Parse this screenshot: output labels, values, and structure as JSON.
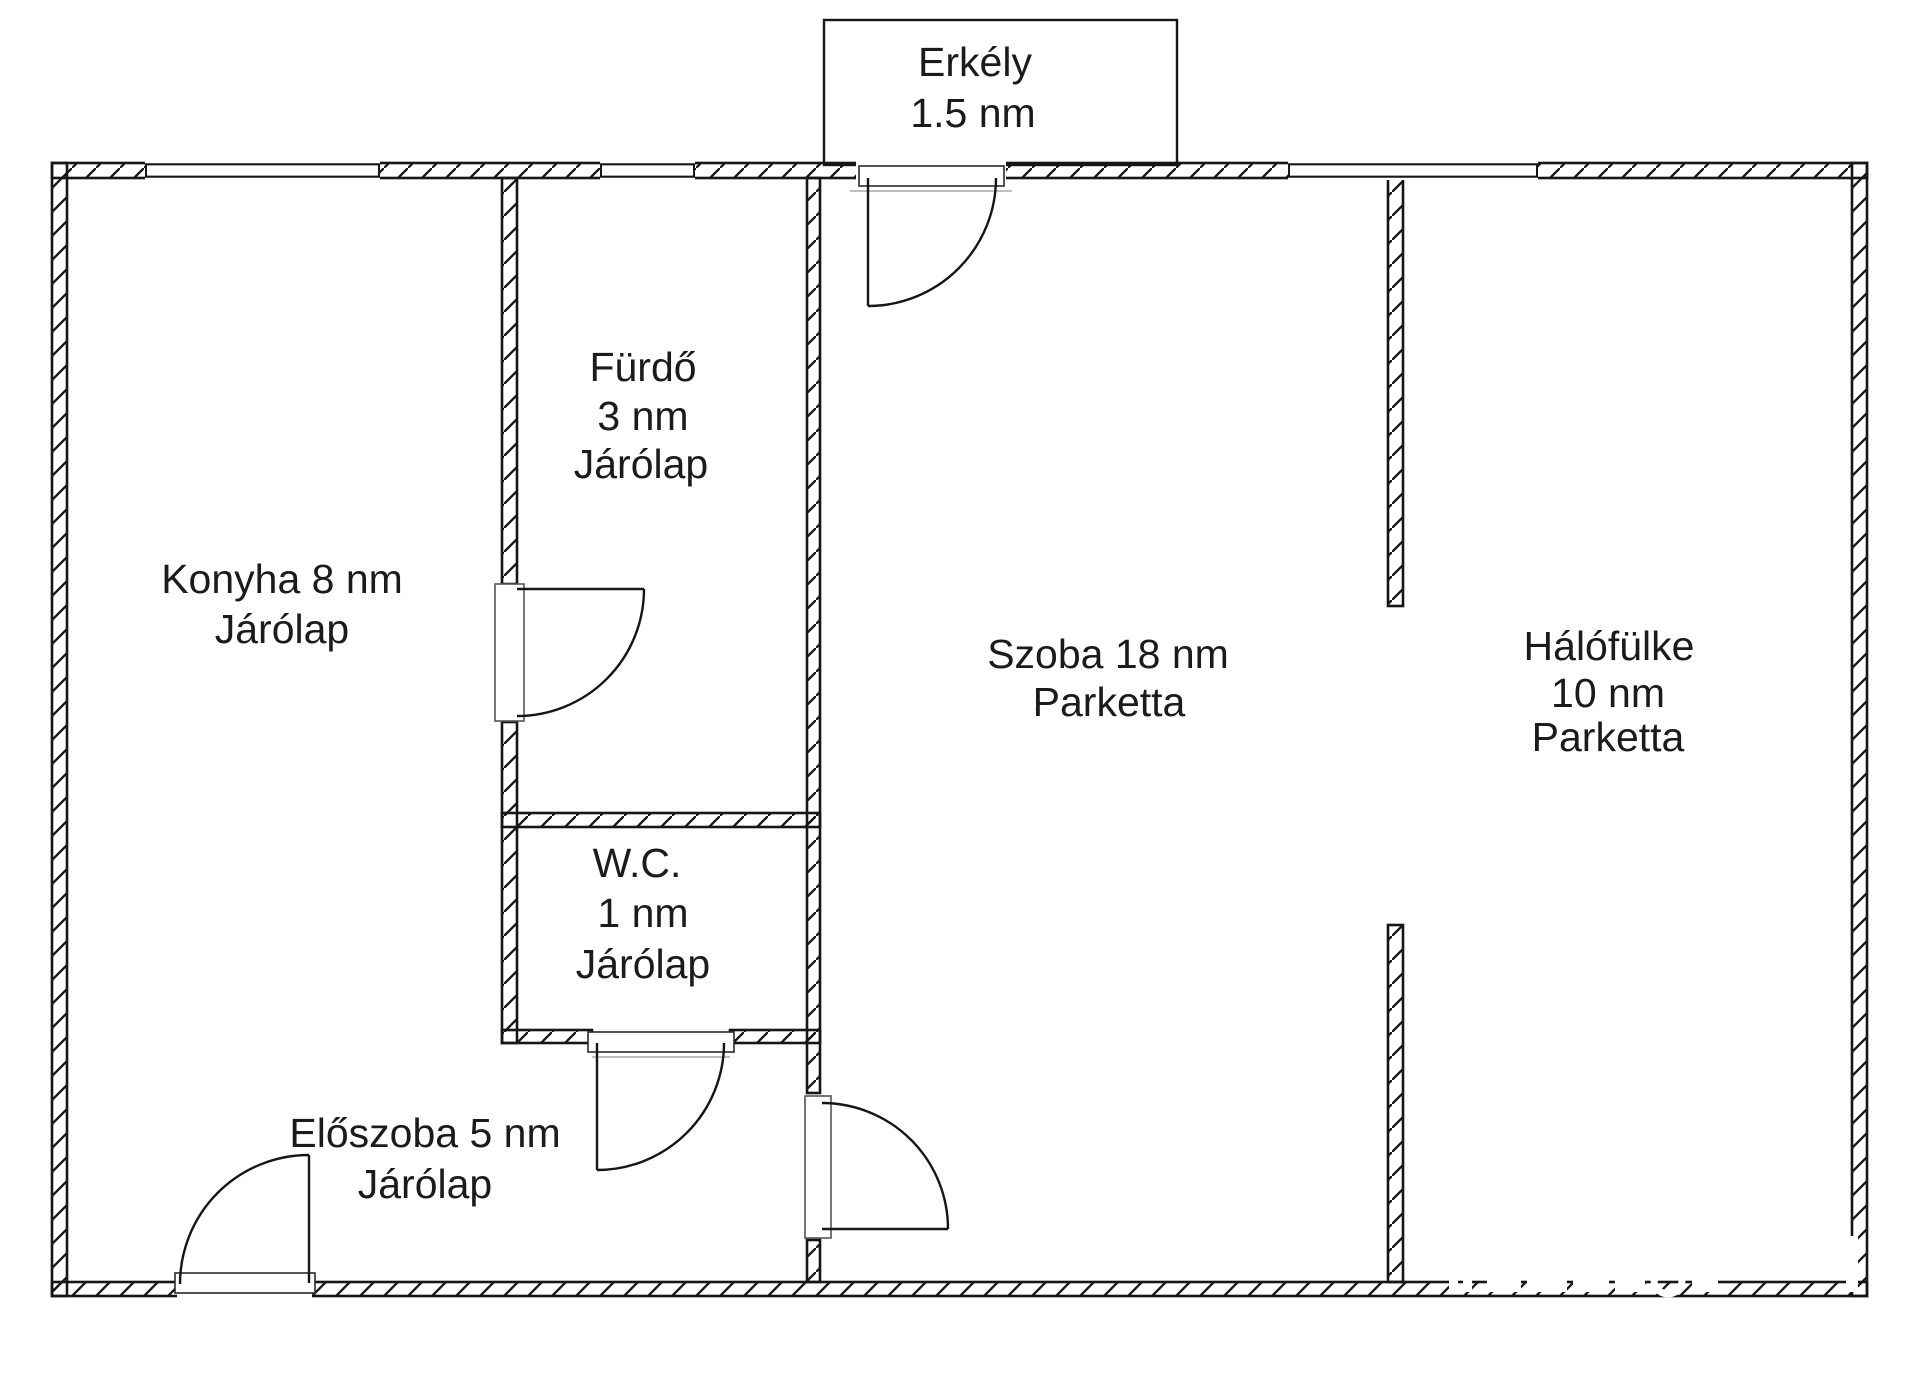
{
  "document": {
    "type": "apartment floor plan",
    "language": "Hungarian"
  },
  "rooms": {
    "balcony": {
      "name": "Erkély",
      "area": "1.5 nm"
    },
    "bathroom": {
      "name": "Fürdő",
      "area": "3 nm",
      "floor": "Járólap"
    },
    "kitchen": {
      "name_area": "Konyha 8 nm",
      "floor": "Járólap"
    },
    "wc": {
      "name": "W.C.",
      "area": "1 nm",
      "floor": "Járólap"
    },
    "living_room": {
      "name_area": "Szoba 18 nm",
      "floor": "Parketta"
    },
    "sleeping_alcove": {
      "name": "Hálófülke",
      "area": "10 nm",
      "floor": "Parketta"
    },
    "hallway": {
      "name_area": "Előszoba 5 nm",
      "floor": "Járólap"
    }
  },
  "colors": {
    "wall_line": "#161616",
    "text": "#1b1b1b",
    "door_frame_gray": "#a8a8a8",
    "background": "#ffffff"
  }
}
